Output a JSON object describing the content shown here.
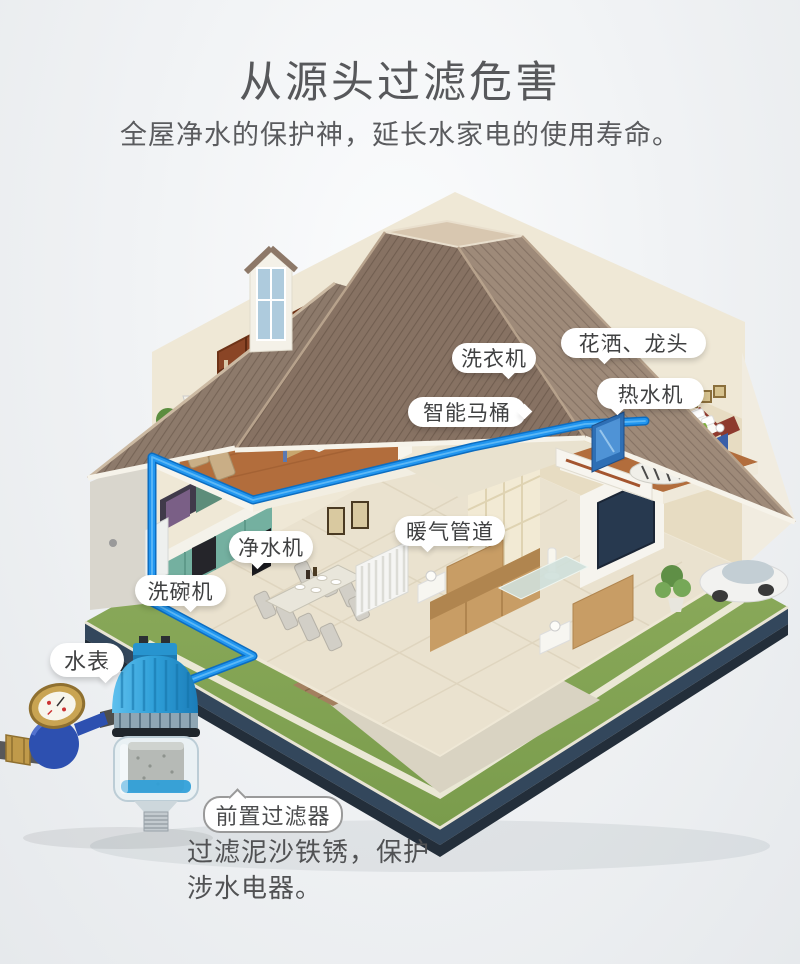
{
  "header": {
    "title": "从源头过滤危害",
    "subtitle": "全屋净水的保护神，延长水家电的使用寿命。"
  },
  "callouts": {
    "washing_machine": "洗衣机",
    "shower_faucet": "花洒、龙头",
    "water_heater": "热水机",
    "smart_toilet": "智能马桶",
    "water_purifier": "净水机",
    "heating_pipes": "暖气管道",
    "dishwasher": "洗碗机",
    "water_meter": "水表",
    "prefilter": "前置过滤器"
  },
  "product_note": {
    "line1": "过滤泥沙铁锈，保护",
    "line2": "涉水电器。"
  },
  "colors": {
    "pipe_blue": "#1b8de8",
    "filter_blue": "#2e9fd8",
    "meter_blue": "#2c4fae",
    "brass": "#c8a254",
    "lawn_green": "#86a654",
    "roof_brown": "#8d7868",
    "label_text": "#454647"
  }
}
